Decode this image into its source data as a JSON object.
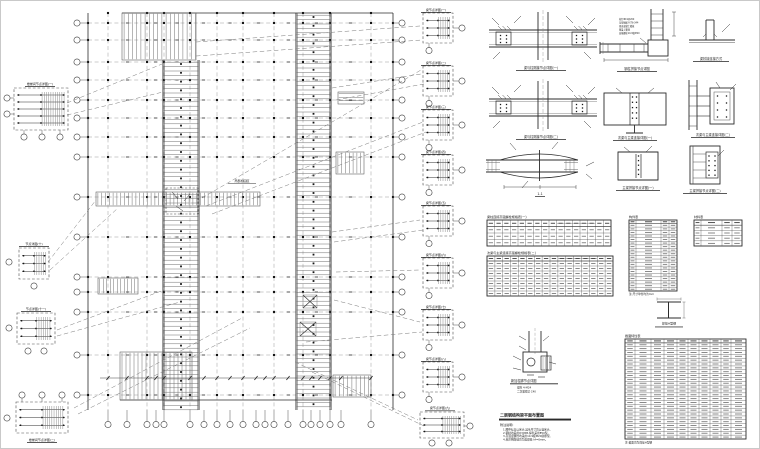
{
  "drawing": {
    "colors": {
      "line": "#2b2b2b",
      "light": "#8d8d8d",
      "hatch": "#6f6f6f",
      "paper": "#ffffff"
    },
    "plan": {
      "right_callout_captions": [
        "梁节点详图(一)",
        "梁节点详图(二)",
        "梁节点详图(三)",
        "梁节点详图(四)",
        "梁节点详图(五)",
        "梁节点详图(六)",
        "梁节点详图(七)",
        "梁节点详图(八)",
        "梁节点详图(九)"
      ],
      "left_callout_captions": [
        "楼梯间节点详图(一)",
        "节点详图(十)",
        "节点详图(十一)",
        "楼梯间节点详图(二)"
      ],
      "area_label": "局部加固区"
    },
    "details": {
      "row1": [
        {
          "caption": "梁与柱刚接节点详图(一)"
        },
        {
          "caption": "钢柱拼接节点详图",
          "anno": [
            "栓钉Φ19@200",
            "压型钢板YX76-344",
            "现浇混凝土楼板",
            "钢梁上翼缘",
            "高强螺栓10.9级M20"
          ]
        },
        {
          "caption": "梁铰接连接方式"
        }
      ],
      "row2": [
        {
          "caption": "梁与柱刚接节点详图(二)"
        },
        {
          "caption": "次梁与主梁连接详图(一)"
        },
        {
          "caption": "次梁与主梁连接详图(二)"
        }
      ],
      "row3": [
        {
          "caption": "1-1"
        },
        {
          "caption": "主梁拼接节点详图(一)"
        },
        {
          "caption": "主梁拼接节点详图(二)"
        }
      ],
      "column_base": {
        "captions": [
          "新加柱脚节点详图",
          "锚栓 4-M24",
          "二次灌浆层 C40"
        ]
      },
      "section_glyph": {
        "caption": "焊接H型钢"
      }
    },
    "tables": {
      "t1": {
        "title": "梁柱连接高强螺栓规格表(一)",
        "rows": 4,
        "cols": 16
      },
      "t2": {
        "title": "次梁与主梁连接高强螺栓规格表(二)",
        "rows": 8,
        "cols": 16
      },
      "t3": {
        "title": "构件表",
        "rows": 20,
        "cols": 4,
        "footer": "注:尺寸单位均为mm"
      },
      "t4": {
        "title": "材料表",
        "rows": 5,
        "cols": 4
      },
      "t5": {
        "title": "截面特性表",
        "rows": 26,
        "cols": 10,
        "footer": "注:截面均为焊接H型钢"
      }
    },
    "notes": {
      "title": "二层钢结构梁平面布置图",
      "heading": "附注说明:",
      "items": [
        "1.图中标高以米计,其余尺寸均以毫米计。",
        "2.钢材均采用Q345B,焊条采用E50型。",
        "3.高强度螺栓均采用10.9级M20摩擦型。",
        "4.未注明焊缝均为角焊缝 hf=6mm。"
      ]
    }
  }
}
